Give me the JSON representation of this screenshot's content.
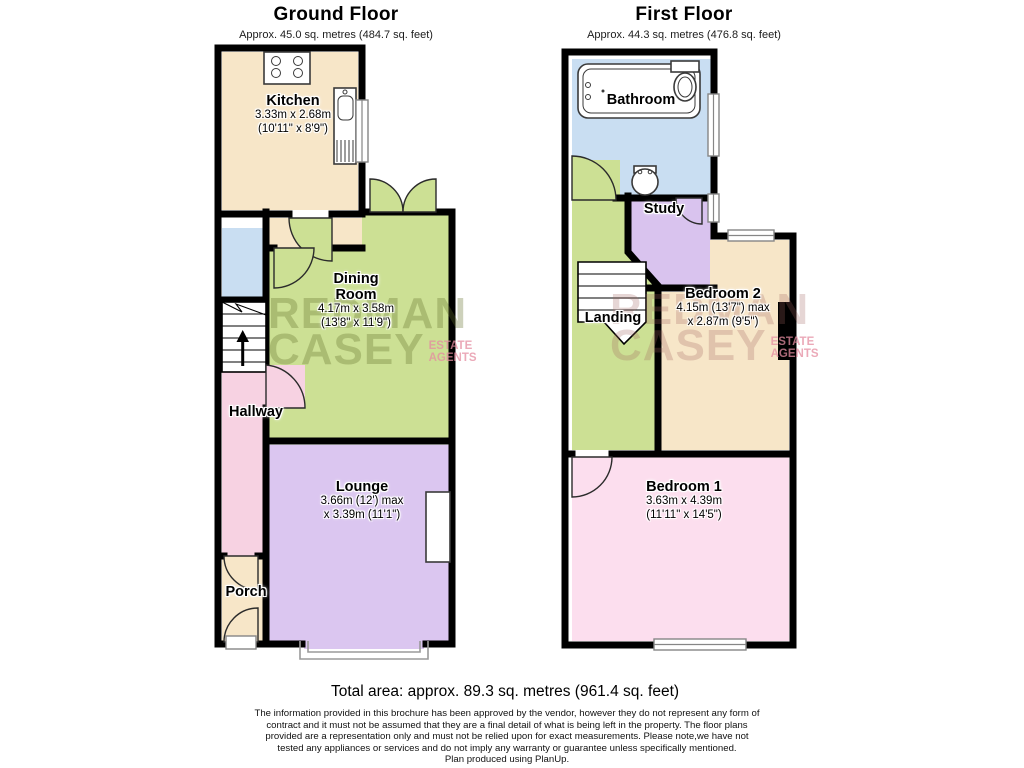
{
  "ground_floor": {
    "title": "Ground Floor",
    "subtitle": "Approx. 45.0 sq. metres (484.7 sq. feet)",
    "rooms": {
      "kitchen": {
        "name": "Kitchen",
        "dim_metric": "3.33m x 2.68m",
        "dim_imperial": "(10'11\" x 8'9\")"
      },
      "dining_room": {
        "name_line1": "Dining",
        "name_line2": "Room",
        "dim_metric": "4.17m x 3.58m",
        "dim_imperial": "(13'8\" x 11'9\")"
      },
      "hallway": {
        "name": "Hallway"
      },
      "lounge": {
        "name": "Lounge",
        "dim_line1": "3.66m (12') max",
        "dim_line2": "x 3.39m (11'1\")"
      },
      "porch": {
        "name": "Porch"
      }
    }
  },
  "first_floor": {
    "title": "First Floor",
    "subtitle": "Approx. 44.3 sq. metres (476.8 sq. feet)",
    "rooms": {
      "bathroom": {
        "name": "Bathroom"
      },
      "study": {
        "name": "Study"
      },
      "landing": {
        "name": "Landing"
      },
      "bedroom2": {
        "name": "Bedroom 2",
        "dim_line1": "4.15m (13'7\") max",
        "dim_line2": "x 2.87m (9'5\")"
      },
      "bedroom1": {
        "name": "Bedroom 1",
        "dim_metric": "3.63m x 4.39m",
        "dim_imperial": "(11'11\" x 14'5\")"
      }
    }
  },
  "footer": {
    "total_area": "Total area: approx. 89.3 sq. metres (961.4 sq. feet)",
    "disclaimer_lines": [
      "The information provided in this brochure has been approved by the vendor, however they do not represent any form of",
      "contract and it must not be assumed that they are a final detail of what is being left in the property. The floor plans",
      "provided are a representation only and must not be relied upon for exact measurements. Please note,we have not",
      "tested any appliances or services and do not imply any warranty or guarantee unless specifically mentioned.",
      "Plan produced using PlanUp."
    ]
  },
  "watermark": {
    "line1": "REDMAN",
    "line2": "CASEY",
    "sub_line1": "ESTATE",
    "sub_line2": "AGENTS"
  },
  "colors": {
    "wall": "#000000",
    "kitchen": "#f7e6c8",
    "dining_room": "#cce094",
    "hallway": "#f7d2e2",
    "lounge": "#dbc6f0",
    "porch": "#f7e6c8",
    "cupboard": "#c9def2",
    "bathroom": "#c9def2",
    "study": "#d9c3ee",
    "landing": "#cce094",
    "bedroom1": "#fcdeee",
    "bedroom2": "#f7e6c8"
  }
}
